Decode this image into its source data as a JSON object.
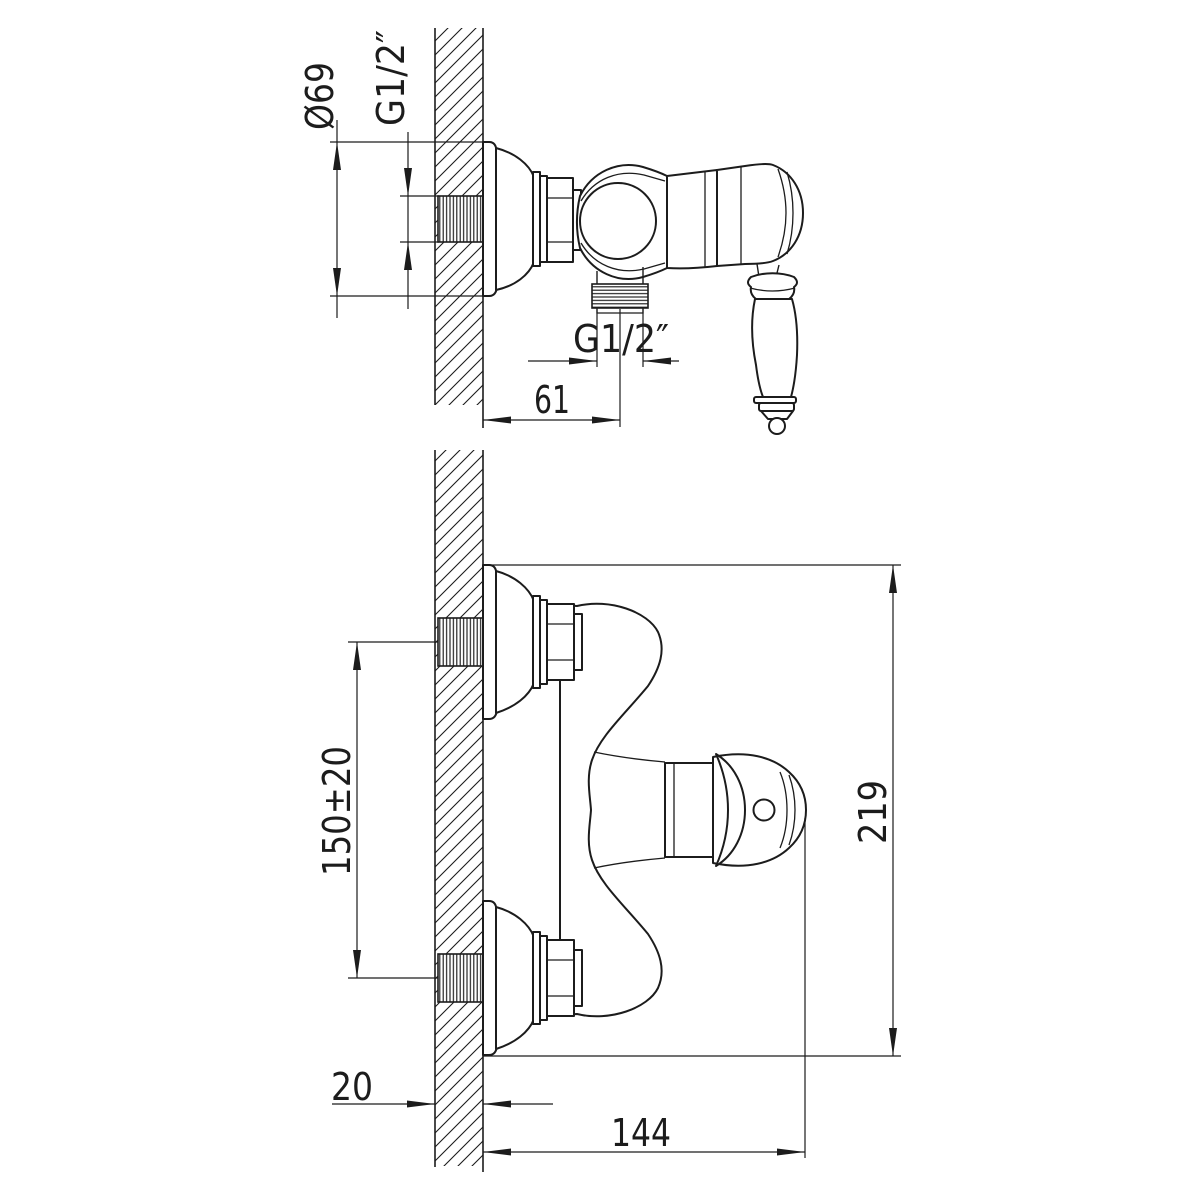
{
  "drawing": {
    "type": "technical dimensional drawing",
    "subject": "wall-mounted single-lever shower mixer, two orthographic views",
    "background_color": "#ffffff",
    "line_color": "#1c1c1c",
    "views": {
      "side": {
        "id": "side-view",
        "dimension_labels": {
          "escutcheon_diameter": "Ø69",
          "wall_thread": "G1/2″",
          "outlet_thread": "G1/2″",
          "outlet_offset": "61"
        }
      },
      "front": {
        "id": "front-view",
        "dimension_labels": {
          "inlet_spacing": "150±20",
          "overall_height": "219",
          "wall_thickness": "20",
          "body_depth": "144"
        }
      }
    }
  }
}
